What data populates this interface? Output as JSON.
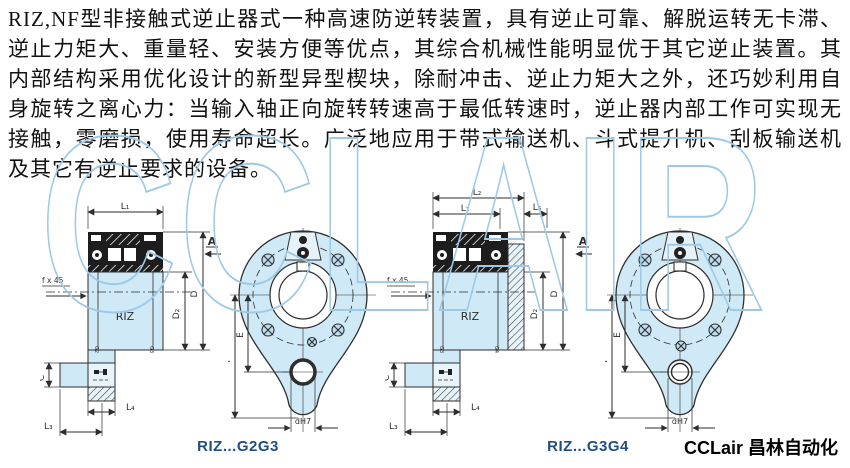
{
  "document": {
    "paragraph": "RIZ,NF型非接触式逆止器式一种高速防逆转装置，具有逆止可靠、解脱运转无卡滞、逆止力矩大、重量轻、安装方便等优点，其综合机械性能明显优于其它逆止装置。其内部结构采用优化设计的新型异型楔块，除耐冲击、逆止力矩大之外，还巧妙利用自身旋转之离心力：当输入轴正向旋转转速高于最低转速时，逆止器内部工作可实现无接触，零磨损，使用寿命超长。广泛地应用于带式输送机、斗式提升机、刮板输送机及其它有逆止要求的设备。",
    "watermark": "CCLAIR",
    "brand": "CCLair 昌林自动化"
  },
  "colors": {
    "diagram_fill": "#cfe9f6",
    "diagram_line": "#2e2e2e",
    "caption_blue": "#1d4e85",
    "watermark_blue": "#9ec9e6"
  },
  "fig_g2g3": {
    "caption": "RIZ...G2G3",
    "section": {
      "l1": "L₁",
      "a": "A",
      "fx45": "f x 45",
      "d2": "D₂",
      "d": "D",
      "body": "RIZ",
      "c": "C",
      "l4": "L₄",
      "l3": "L₃",
      "g_left": "G2",
      "g_right": "G3"
    },
    "front": {
      "e": "E",
      "f": "F",
      "dh7": "dH7"
    }
  },
  "fig_g3g4": {
    "caption": "RIZ...G3G4",
    "section": {
      "l2": "L₂",
      "l1": "L₁",
      "l5": "L₅",
      "a": "A",
      "fx45": "f x 45",
      "d2": "D₂",
      "d": "D",
      "body": "RIZ",
      "c": "C",
      "l4": "L₄",
      "l3": "L₃",
      "g_left": "G3",
      "g_right": "G4"
    },
    "front": {
      "e": "E",
      "f": "F",
      "dh7": "dH7"
    }
  }
}
